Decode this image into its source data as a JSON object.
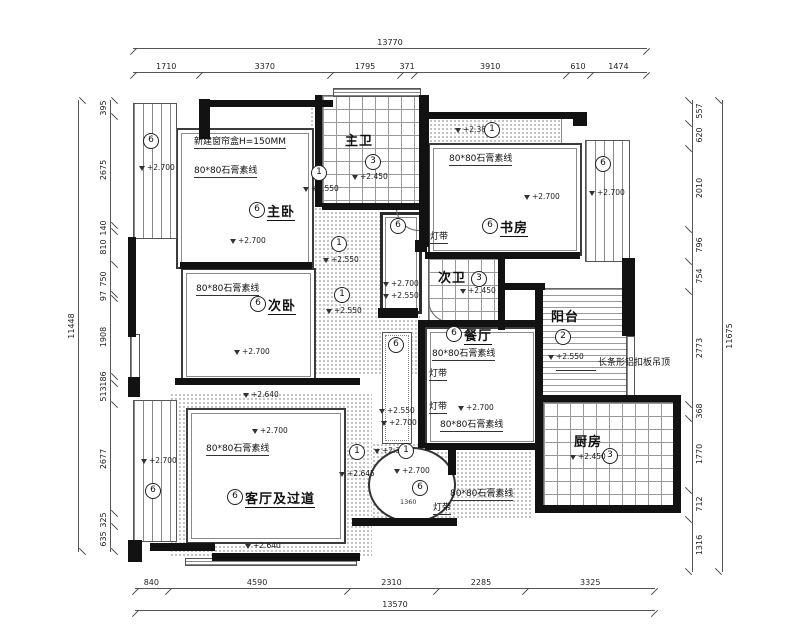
{
  "dims": {
    "top": {
      "total": "13770",
      "segs": [
        "1710",
        "3370",
        "1795",
        "371",
        "3910",
        "610",
        "1474"
      ]
    },
    "bottom": {
      "total": "13570",
      "segs": [
        "840",
        "4590",
        "2310",
        "2285",
        "3325"
      ]
    },
    "left": {
      "total": "11448",
      "segs": [
        "395",
        "2675",
        "140",
        "810",
        "750",
        "97",
        "1908",
        "186",
        "513",
        "2677",
        "325",
        "635"
      ]
    },
    "right": {
      "total": "11675",
      "segs": [
        "557",
        "620",
        "2010",
        "796",
        "754",
        "2773",
        "368",
        "1770",
        "712",
        "1316"
      ]
    }
  },
  "rooms": {
    "master_bedroom": {
      "tag": "6",
      "name": "主卧",
      "lv": "+2.700"
    },
    "second_bedroom": {
      "tag": "6",
      "name": "次卧",
      "lv": "+2.700"
    },
    "living": {
      "tag": "6",
      "name": "客厅及过道",
      "lv": "+2.700"
    },
    "study": {
      "tag": "6",
      "name": "书房",
      "lv": "+2.700"
    },
    "dining": {
      "tag": "6",
      "name": "餐厅",
      "lv": "+2.700"
    },
    "master_bath": {
      "tag": "3",
      "name": "主卫",
      "lv": "+2.450"
    },
    "second_bath": {
      "tag": "3",
      "name": "次卫",
      "lv": "+2.450"
    },
    "kitchen": {
      "tag": "3",
      "name": "厨房",
      "lv": "+2.450"
    },
    "balcony": {
      "tag": "2",
      "name": "阳台",
      "lv": "+2.550"
    }
  },
  "notes": {
    "curtain_box": "新建窗帘盒H=150MM",
    "gypsum": "80*80石膏素线",
    "light_strip": "灯带",
    "alu_ceiling": "长条形铝扣板吊顶"
  },
  "levels": {
    "l2700": "+2.700",
    "l2640": "+2.640",
    "l2645": "+2.645",
    "l2550": "+2.550",
    "l2450": "+2.450",
    "l2380": "+2.380"
  },
  "tags": {
    "t1": "1",
    "t2": "2",
    "t3": "3",
    "t6": "6"
  },
  "small_dims": {
    "oval_width": "1360"
  }
}
